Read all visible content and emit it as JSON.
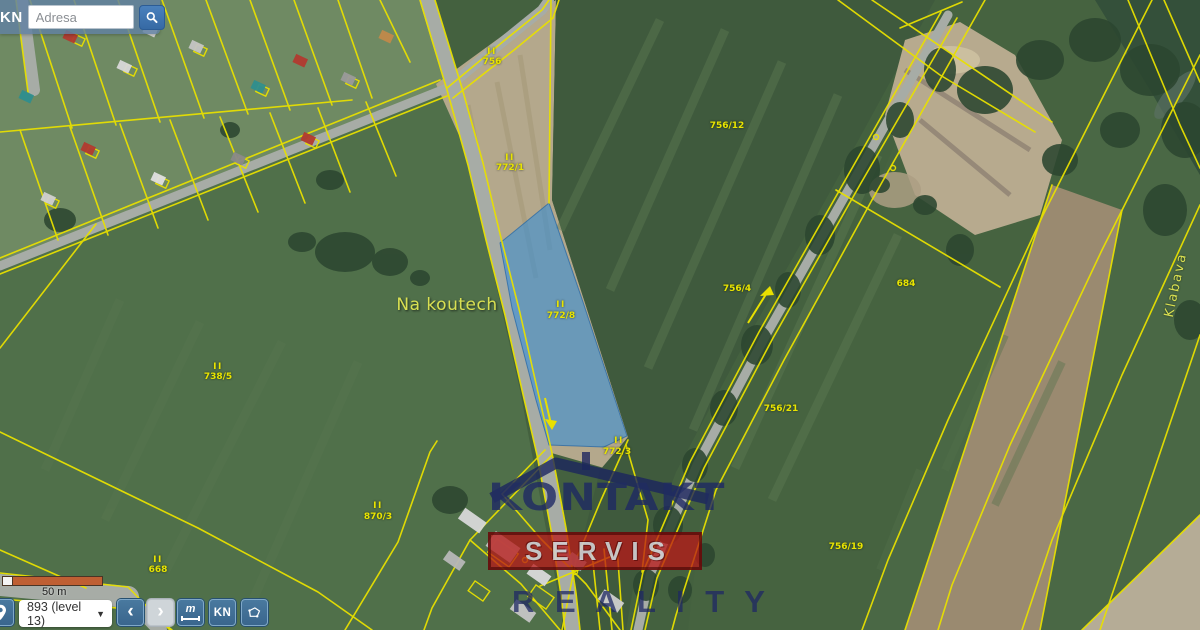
{
  "header": {
    "kn_label": "KN",
    "search_placeholder": "Adresa"
  },
  "toolbar": {
    "scale_label": "50 m",
    "zoom_level": "893 (level 13)",
    "caret": "▼",
    "back_icon": "‹",
    "forward_icon": "›",
    "measure_letter": "m",
    "kn_label": "KN"
  },
  "watermark": {
    "line1": "KONTAKT",
    "line2": "SERVIS",
    "line3": "R E A L I T Y"
  },
  "map": {
    "highlight_color": "#2d8cdc",
    "parcel_line_color": "#e8e000",
    "labels": [
      {
        "text": "II",
        "x": 492,
        "y": 52,
        "cls": "roman"
      },
      {
        "text": "756",
        "x": 492,
        "y": 62,
        "cls": "parcel"
      },
      {
        "text": "II",
        "x": 510,
        "y": 158,
        "cls": "roman"
      },
      {
        "text": "772/1",
        "x": 510,
        "y": 168,
        "cls": "parcel"
      },
      {
        "text": "II",
        "x": 561,
        "y": 305,
        "cls": "roman"
      },
      {
        "text": "772/8",
        "x": 561,
        "y": 316,
        "cls": "parcel"
      },
      {
        "text": "II",
        "x": 619,
        "y": 441,
        "cls": "roman"
      },
      {
        "text": "772/3",
        "x": 617,
        "y": 452,
        "cls": "parcel"
      },
      {
        "text": "756/12",
        "x": 727,
        "y": 126,
        "cls": "parcel"
      },
      {
        "text": "756/4",
        "x": 737,
        "y": 289,
        "cls": "parcel"
      },
      {
        "text": "756/21",
        "x": 781,
        "y": 409,
        "cls": "parcel"
      },
      {
        "text": "684",
        "x": 906,
        "y": 284,
        "cls": "parcel"
      },
      {
        "text": "756/19",
        "x": 846,
        "y": 547,
        "cls": "parcel"
      },
      {
        "text": "II",
        "x": 218,
        "y": 367,
        "cls": "roman"
      },
      {
        "text": "738/5",
        "x": 218,
        "y": 377,
        "cls": "parcel"
      },
      {
        "text": "II",
        "x": 158,
        "y": 560,
        "cls": "roman"
      },
      {
        "text": "668",
        "x": 158,
        "y": 570,
        "cls": "parcel"
      },
      {
        "text": "II",
        "x": 378,
        "y": 506,
        "cls": "roman"
      },
      {
        "text": "870/3",
        "x": 378,
        "y": 517,
        "cls": "parcel"
      },
      {
        "text": "Na koutech",
        "x": 447,
        "y": 305,
        "cls": "place"
      },
      {
        "text": "Klabava",
        "x": 1176,
        "y": 285,
        "cls": "river",
        "rot": -78
      }
    ]
  }
}
